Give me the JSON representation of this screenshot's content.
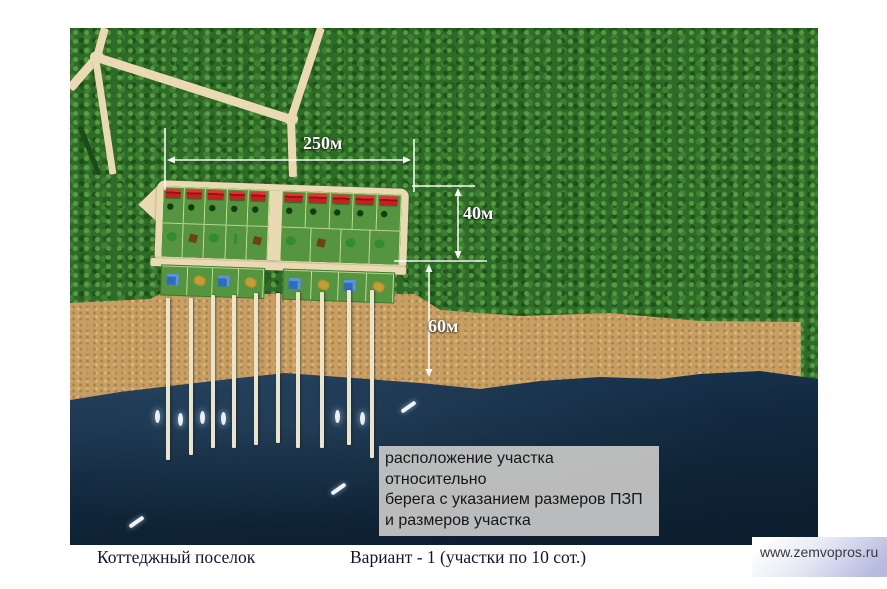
{
  "scene": {
    "type": "aerial-site-plan",
    "dimension_labels": {
      "settlement_width": "250м",
      "plot_depth": "40м",
      "beach_depth": "60м"
    },
    "note_box": {
      "lines": [
        "расположение участка относительно",
        "берега с указанием размеров ПЗП",
        "и размеров участка"
      ]
    },
    "captions": {
      "left": "Коттеджный поселок",
      "right": "Вариант - 1 (участки по 10 сот.)"
    },
    "watermark": "www.zemvopros.ru",
    "features": {
      "red_roof_cottages": 10,
      "piers": 10
    },
    "colors": {
      "forest": "#2f6b28",
      "beach": "#c79f63",
      "water": "#122940",
      "road": "#e9dab3",
      "plot_green": "#56953f",
      "roof_red": "#c62121",
      "annotation": "#ffffff",
      "note_bg": "#c2c2c2",
      "watermark_bg": "#b6badf"
    }
  }
}
